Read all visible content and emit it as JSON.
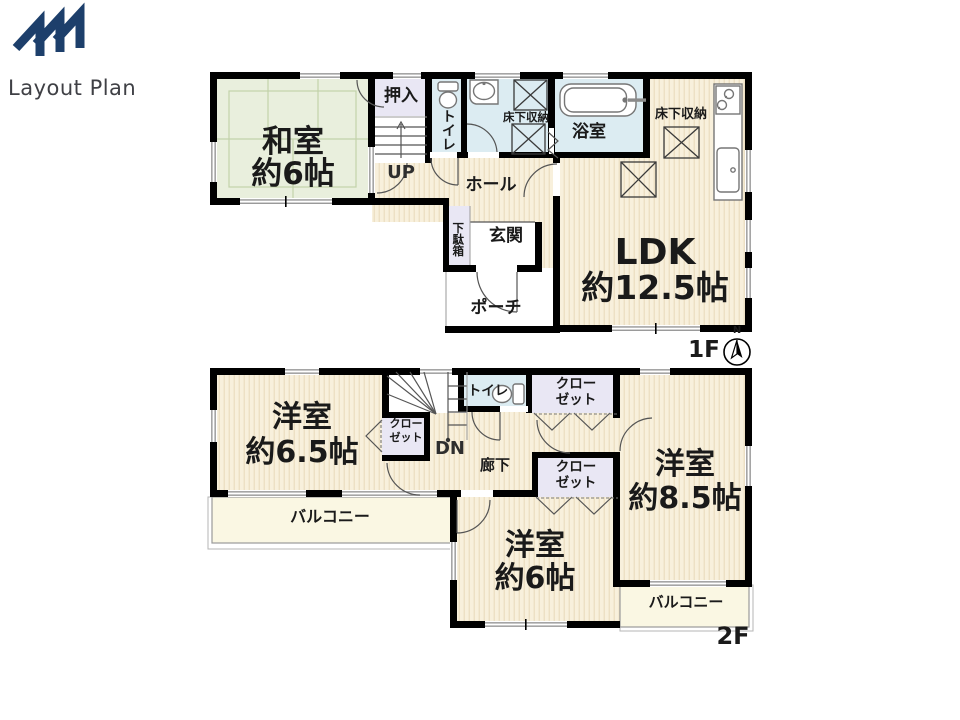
{
  "logo": {
    "title": "Layout Plan"
  },
  "colors": {
    "wall": "#000000",
    "wet": "#dcecf2",
    "closet": "#e9e7f4",
    "balcony": "#faf7e3",
    "tatami": "#e9efdd",
    "tatami_line": "#c2d2aa",
    "wood": "#f8f0dc",
    "wood_stripe": "#ecdfc1",
    "accent_navy": "#1d3f6b",
    "text": "#1a1a1a"
  },
  "floor1": {
    "label": "1F",
    "compass_north": "N",
    "rooms": {
      "washitsu": {
        "name": "和室",
        "size": "約6帖"
      },
      "oshiire": {
        "name": "押入"
      },
      "stairs": {
        "name": "UP"
      },
      "toilet": {
        "name": "トイレ"
      },
      "underfloor1": {
        "name": "床下収納"
      },
      "bathroom": {
        "name": "浴室"
      },
      "underfloor2": {
        "name": "床下収納"
      },
      "ldk": {
        "name": "LDK",
        "size": "約12.5帖"
      },
      "hall": {
        "name": "ホール"
      },
      "getabako": {
        "name": "下駄箱"
      },
      "genkan": {
        "name": "玄関"
      },
      "porch": {
        "name": "ポーチ"
      }
    }
  },
  "floor2": {
    "label": "2F",
    "rooms": {
      "western65": {
        "name": "洋室",
        "size": "約6.5帖"
      },
      "closet1": {
        "line1": "クロー",
        "line2": "ゼット"
      },
      "closet2": {
        "line1": "クロー",
        "line2": "ゼット"
      },
      "closet3": {
        "line1": "クロー",
        "line2": "ゼット"
      },
      "stairs": {
        "name": "DN"
      },
      "toilet": {
        "name": "トイレ"
      },
      "corridor": {
        "name": "廊下"
      },
      "western85": {
        "name": "洋室",
        "size": "約8.5帖"
      },
      "western6": {
        "name": "洋室",
        "size": "約6帖"
      },
      "balcony_left": {
        "name": "バルコニー"
      },
      "balcony_right": {
        "name": "バルコニー"
      }
    }
  }
}
